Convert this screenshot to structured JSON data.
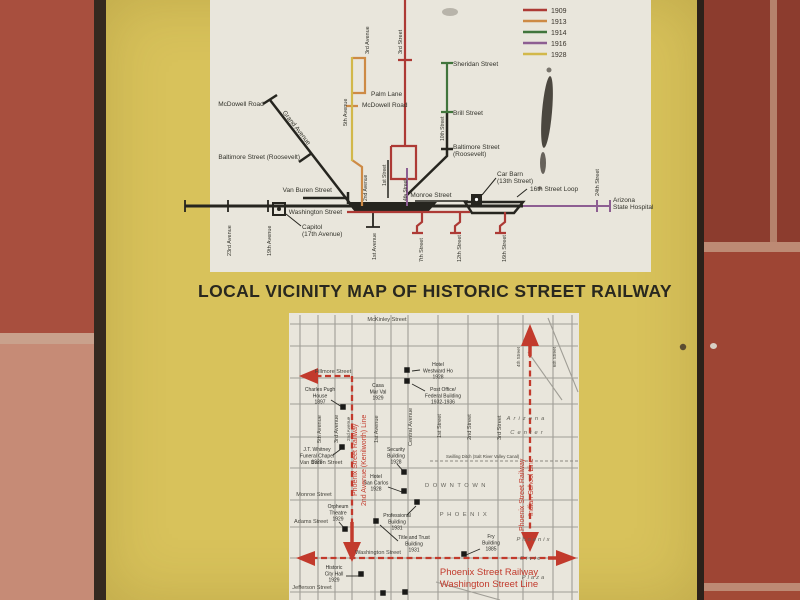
{
  "palette": {
    "wall": "#8f3c2e",
    "tile_top_left": "#a84f3e",
    "tile_bottom_left": "#c68b76",
    "grout": "#c9a18c",
    "brick_right_top": "#8c3c2e",
    "brick_right_bottom": "#9e4534",
    "grout_right": "#bd8a74",
    "panel": "#d8c25b",
    "frame": "#35291f",
    "frame2": "#2c211a",
    "map_bg": "#e9e6dc",
    "ink": "#26251f",
    "grid": "#a09e96",
    "route": "#c23a2c",
    "label_text": "#33332b",
    "street_text": "#45443c",
    "district_text": "#63625a",
    "building_text": "#2b2b26",
    "legend_text": "#3a342c"
  },
  "title": {
    "text": "LOCAL VICINITY MAP OF HISTORIC STREET RAILWAY"
  },
  "legend": {
    "items": [
      {
        "year": "1909",
        "color": "#ad3a35"
      },
      {
        "year": "1913",
        "color": "#cd8a45"
      },
      {
        "year": "1914",
        "color": "#41753c"
      },
      {
        "year": "1916",
        "color": "#8d5e92"
      },
      {
        "year": "1928",
        "color": "#d2b84a"
      }
    ]
  },
  "top_map": {
    "labels": [
      {
        "t": "McDowell Road",
        "x": 241,
        "y": 106,
        "a": "m"
      },
      {
        "t": "Grand Avenue",
        "x": 295,
        "y": 129,
        "r": 52,
        "a": "m"
      },
      {
        "t": "Baltimore Street (Roosevelt)",
        "x": 300,
        "y": 159,
        "a": "e"
      },
      {
        "t": "Van Buren Street",
        "x": 332,
        "y": 192,
        "a": "e"
      },
      {
        "t": "Washington Street",
        "x": 342,
        "y": 214,
        "a": "e"
      },
      {
        "ls": [
          "Capitol",
          "(17th Avenue)"
        ],
        "x": 302,
        "y": 229,
        "a": "s"
      },
      {
        "t": "23rd Avenue",
        "x": 231,
        "y": 256,
        "r": -90,
        "a": "s",
        "s": 5.5
      },
      {
        "t": "19th Avenue",
        "x": 271,
        "y": 256,
        "r": -90,
        "a": "s",
        "s": 5.5
      },
      {
        "t": "1st Avenue",
        "x": 376,
        "y": 260,
        "r": -90,
        "a": "s",
        "s": 5.5
      },
      {
        "t": "5th Avenue",
        "x": 347,
        "y": 126,
        "r": -90,
        "a": "s",
        "s": 5.5
      },
      {
        "t": "3rd Avenue",
        "x": 369,
        "y": 54,
        "r": -90,
        "a": "s",
        "s": 5.5
      },
      {
        "t": "3rd Street",
        "x": 402,
        "y": 54,
        "r": -90,
        "a": "s",
        "s": 5.5
      },
      {
        "t": "Palm Lane",
        "x": 371,
        "y": 96,
        "a": "s"
      },
      {
        "t": "McDowell Road",
        "x": 362,
        "y": 107,
        "a": "s"
      },
      {
        "t": "2nd Avenue",
        "x": 367,
        "y": 201,
        "r": -90,
        "a": "s",
        "s": 5
      },
      {
        "t": "1st Street",
        "x": 386,
        "y": 186,
        "r": -90,
        "a": "s",
        "s": 5
      },
      {
        "t": "4th Street",
        "x": 407,
        "y": 201,
        "r": -90,
        "a": "s",
        "s": 5
      },
      {
        "t": "Monroe Street",
        "x": 431,
        "y": 197,
        "a": "m"
      },
      {
        "t": "Sheridan Street",
        "x": 453,
        "y": 66,
        "a": "s"
      },
      {
        "t": "Brill Street",
        "x": 453,
        "y": 115,
        "a": "s"
      },
      {
        "t": "10th Street",
        "x": 444,
        "y": 141,
        "r": -90,
        "a": "s",
        "s": 5
      },
      {
        "ls": [
          "Baltimore Street",
          "(Roosevelt)"
        ],
        "x": 453,
        "y": 149,
        "a": "s"
      },
      {
        "ls": [
          "Car Barn",
          "(13th Street)"
        ],
        "x": 497,
        "y": 176,
        "a": "s"
      },
      {
        "t": "16th Street Loop",
        "x": 530,
        "y": 191,
        "a": "s"
      },
      {
        "t": "7th Street",
        "x": 423,
        "y": 262,
        "r": -90,
        "a": "s",
        "s": 5.5
      },
      {
        "t": "12th Street",
        "x": 461,
        "y": 262,
        "r": -90,
        "a": "s",
        "s": 5.5
      },
      {
        "t": "16th Street",
        "x": 506,
        "y": 262,
        "r": -90,
        "a": "s",
        "s": 5.5
      },
      {
        "t": "24th Street",
        "x": 599,
        "y": 196,
        "r": -90,
        "a": "s",
        "s": 5.5
      },
      {
        "ls": [
          "Arizona",
          "State Hospital"
        ],
        "x": 613,
        "y": 202,
        "a": "s"
      }
    ]
  },
  "bottom_map": {
    "streets": [
      {
        "t": "McKinley Street",
        "x": 387,
        "y": 321,
        "a": "m"
      },
      {
        "t": "Fillmore Street",
        "x": 333,
        "y": 373,
        "a": "m"
      },
      {
        "t": "Van Buren Street",
        "x": 321,
        "y": 464,
        "a": "m"
      },
      {
        "t": "Monroe Street",
        "x": 314,
        "y": 496,
        "a": "m"
      },
      {
        "t": "Adams Street",
        "x": 311,
        "y": 523,
        "a": "m"
      },
      {
        "t": "Washington Street",
        "x": 378,
        "y": 554,
        "a": "m"
      },
      {
        "t": "Jefferson Street",
        "x": 312,
        "y": 589,
        "a": "m"
      },
      {
        "t": "5th Avenue",
        "x": 321,
        "y": 443,
        "r": -90,
        "a": "s"
      },
      {
        "t": "3rd Avenue",
        "x": 338,
        "y": 443,
        "r": -90,
        "a": "s"
      },
      {
        "t": "2nd Avenue",
        "x": 350,
        "y": 441,
        "r": -90,
        "a": "s",
        "s": 4.6
      },
      {
        "t": "1st Avenue",
        "x": 378,
        "y": 443,
        "r": -90,
        "a": "s"
      },
      {
        "t": "Central Avenue",
        "x": 412,
        "y": 446,
        "r": -90,
        "a": "s"
      },
      {
        "t": "1st Street",
        "x": 441,
        "y": 438,
        "r": -90,
        "a": "s"
      },
      {
        "t": "2nd Street",
        "x": 471,
        "y": 440,
        "r": -90,
        "a": "s"
      },
      {
        "t": "3rd Street",
        "x": 501,
        "y": 440,
        "r": -90,
        "a": "s"
      },
      {
        "t": "4th Street",
        "x": 520,
        "y": 367,
        "r": -90,
        "a": "s",
        "s": 4.6
      },
      {
        "t": "6th Street",
        "x": 556,
        "y": 367,
        "r": -90,
        "a": "s",
        "s": 4.6
      },
      {
        "t": "Swilling Ditch (Salt River Valley Canal)",
        "x": 446,
        "y": 458,
        "a": "s",
        "s": 4.3
      }
    ],
    "districts": [
      {
        "t": "Arizona",
        "x": 527,
        "y": 420,
        "a": "m",
        "sp": 3,
        "it": true
      },
      {
        "t": "Center",
        "x": 528,
        "y": 434,
        "a": "m",
        "sp": 3,
        "it": true
      },
      {
        "t": "DOWNTOWN",
        "x": 457,
        "y": 487,
        "a": "m",
        "sp": 3.5
      },
      {
        "t": "PHOENIX",
        "x": 465,
        "y": 516,
        "a": "m",
        "sp": 3.5
      },
      {
        "t": "Phoenix",
        "x": 534,
        "y": 541,
        "a": "m",
        "sp": 2,
        "it": true
      },
      {
        "t": "Civic",
        "x": 531,
        "y": 560,
        "a": "m",
        "sp": 2,
        "it": true
      },
      {
        "t": "Plaza",
        "x": 534,
        "y": 579,
        "a": "m",
        "sp": 2,
        "it": true
      }
    ],
    "route_labels": [
      {
        "t": "Phoenix Street Railway",
        "x": 357,
        "y": 496,
        "r": -90,
        "a": "s"
      },
      {
        "t": "2nd Avenue (Kenilworth) Line",
        "x": 366,
        "y": 506,
        "r": -90,
        "a": "s"
      },
      {
        "t": "Phoenix Street Railway",
        "x": 524,
        "y": 531,
        "r": -90,
        "a": "s"
      },
      {
        "t": "Indian School Line",
        "x": 533,
        "y": 516,
        "r": -90,
        "a": "s"
      },
      {
        "t": "Phoenix Street Railway",
        "x": 489,
        "y": 575,
        "a": "m",
        "s": 9.5
      },
      {
        "t": "Washington Street Line",
        "x": 489,
        "y": 587,
        "a": "m",
        "s": 9.5
      }
    ],
    "buildings": [
      {
        "lines": [
          "Charles Pugh",
          "House",
          "1897"
        ],
        "x": 320,
        "y": 391,
        "sq": [
          343,
          407
        ],
        "leader": [
          331,
          400,
          342,
          407
        ]
      },
      {
        "lines": [
          "Casa",
          "Mar Val",
          "1929"
        ],
        "x": 378,
        "y": 387
      },
      {
        "lines": [
          "Hotel",
          "Westward Ho",
          "1928"
        ],
        "x": 438,
        "y": 366,
        "sq": [
          407,
          370
        ],
        "leader": [
          420,
          370,
          412,
          371
        ]
      },
      {
        "lines": [
          "Post Office/",
          "Federal Building",
          "1932-1936"
        ],
        "x": 443,
        "y": 391,
        "sq": [
          407,
          381
        ],
        "leader": [
          425,
          391,
          412,
          384
        ]
      },
      {
        "lines": [
          "J.T. Whitney",
          "Funeral Chapel",
          "1928"
        ],
        "x": 317,
        "y": 451,
        "sq": [
          342,
          447
        ],
        "leader": [
          333,
          455,
          341,
          449
        ]
      },
      {
        "lines": [
          "Security",
          "Building",
          "1928"
        ],
        "x": 396,
        "y": 451,
        "sq": [
          404,
          472
        ],
        "leader": [
          397,
          464,
          404,
          472
        ]
      },
      {
        "lines": [
          "Hotel",
          "San Carlos",
          "1928"
        ],
        "x": 376,
        "y": 478,
        "sq": [
          404,
          491
        ],
        "leader": [
          388,
          487,
          402,
          492
        ]
      },
      {
        "lines": [
          "Orpheum",
          "Theatre",
          "1929"
        ],
        "x": 338,
        "y": 508,
        "sq": [
          345,
          529
        ],
        "leader": [
          339,
          522,
          345,
          529
        ]
      },
      {
        "lines": [
          "Professional",
          "Building",
          "1931"
        ],
        "x": 397,
        "y": 517,
        "sq": [
          417,
          502
        ],
        "leader": [
          407,
          515,
          416,
          506
        ]
      },
      {
        "lines": [
          "Title and Trust",
          "Building",
          "1931"
        ],
        "x": 414,
        "y": 539,
        "sq": [
          376,
          521
        ],
        "leader": [
          398,
          541,
          380,
          525
        ]
      },
      {
        "lines": [
          "Historic",
          "City Hall",
          "1929"
        ],
        "x": 334,
        "y": 569,
        "sq": [
          361,
          574
        ],
        "leader": [
          346,
          576,
          359,
          576
        ]
      },
      {
        "lines": [
          "Fry",
          "Building",
          "1885"
        ],
        "x": 491,
        "y": 538,
        "sq": [
          464,
          554
        ],
        "leader": [
          480,
          549,
          466,
          555
        ]
      },
      {
        "lines": [],
        "sq": [
          383,
          593
        ]
      },
      {
        "lines": [],
        "sq": [
          405,
          592
        ]
      }
    ]
  }
}
